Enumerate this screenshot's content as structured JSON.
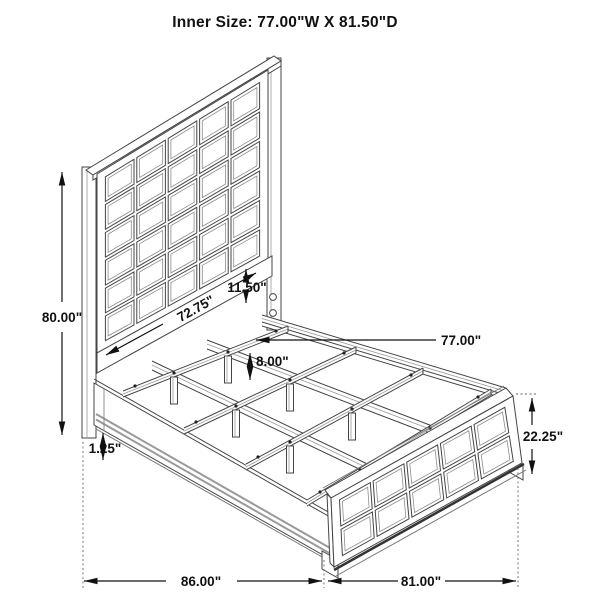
{
  "title": "Inner Size: 77.00\"W X 81.50\"D",
  "dimensions": {
    "overall_height": "80.00\"",
    "headboard_width": "72.75\"",
    "headboard_clearance": "11.50\"",
    "inner_width": "77.00\"",
    "leg_height": "8.00\"",
    "rail_trim": "1.25\"",
    "footboard_height": "22.25\"",
    "overall_depth": "86.00\"",
    "overall_width": "81.00\""
  },
  "colors": {
    "line_dark": "#454545",
    "line_light": "#9a9a9a",
    "dimension": "#111111",
    "background": "#ffffff"
  }
}
